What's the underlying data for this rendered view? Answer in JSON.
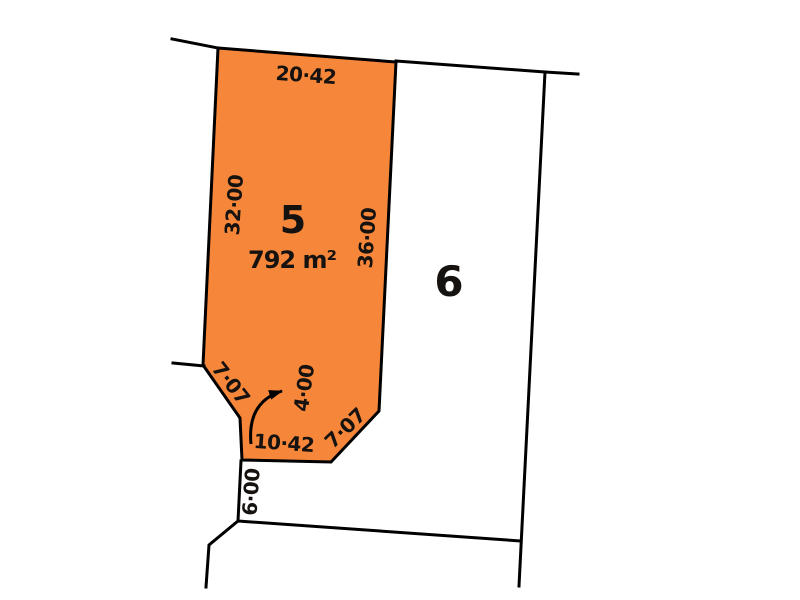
{
  "plan": {
    "type": "cadastral-survey-plan",
    "colors": {
      "highlight_fill": "#f6873a",
      "line": "#000000",
      "background": "#ffffff",
      "text": "#161210"
    },
    "lot5": {
      "number": "5",
      "area": "792 m²",
      "highlighted": true,
      "dim_top": "20·42",
      "dim_left": "32·00",
      "dim_right": "36·00",
      "dim_chamfer_left": "7·07",
      "dim_splay": "4·00",
      "dim_bottom": "10·42",
      "dim_chamfer_right": "7·07"
    },
    "lot6": {
      "number": "6",
      "highlighted": false
    },
    "dim_below_lot5": "6·00"
  }
}
